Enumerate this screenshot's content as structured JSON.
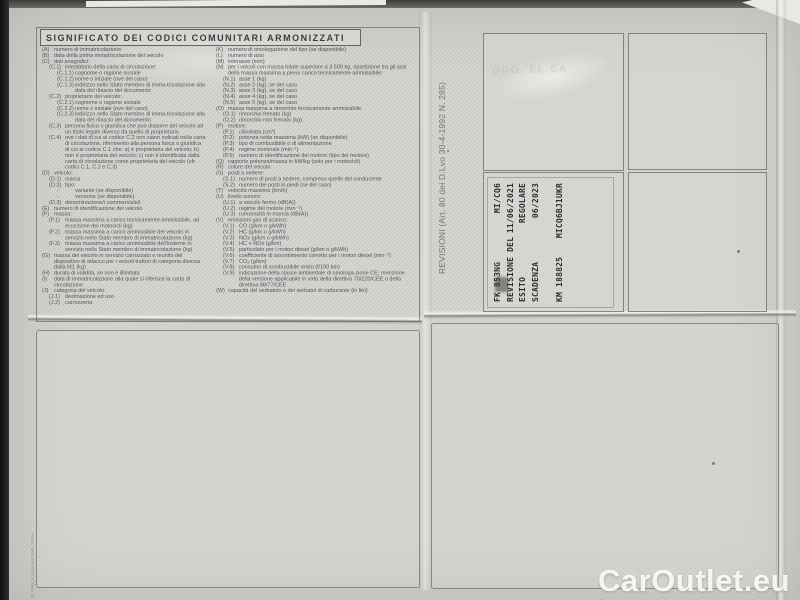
{
  "colors": {
    "paper": "#d6d5d1",
    "legend_ink": "#56565a",
    "stamp_ink": "#2d2d2f",
    "border": "#76766e",
    "watermark_text": "#fdfdfa"
  },
  "header": {
    "title": "SIGNIFICATO DEI CODICI COMUNITARI ARMONIZZATI"
  },
  "legend": {
    "left": [
      {
        "c": "(A)",
        "t": "numero di immatricolazione",
        "i": 0
      },
      {
        "c": "(B)",
        "t": "data della prima immatricolazione del veicolo",
        "i": 0
      },
      {
        "c": "(C)",
        "t": "dati anagrafici:",
        "i": 0
      },
      {
        "c": "(C.1)",
        "t": "intestatario della carta di circolazione:",
        "i": 1
      },
      {
        "c": "(C.1.1)",
        "t": "cognome o ragione sociale",
        "i": 2
      },
      {
        "c": "(C.1.2)",
        "t": "nome o iniziale (ove del caso)",
        "i": 2
      },
      {
        "c": "(C.1.3)",
        "t": "indirizzo nello Stato membro di imma-tricolazione alla data del rilascio del documento",
        "i": 2
      },
      {
        "c": "(C.2)",
        "t": "proprietario del veicolo:",
        "i": 1
      },
      {
        "c": "(C.2.1)",
        "t": "cognome o ragione sociale",
        "i": 2
      },
      {
        "c": "(C.2.2)",
        "t": "nome o iniziale (ove del caso)",
        "i": 2
      },
      {
        "c": "(C.2.3)",
        "t": "indirizzo nello Stato membro di imma-tricolazione alla data del rilascio del documento",
        "i": 2
      },
      {
        "c": "(C.3)",
        "t": "persona fisica o giuridica che può disporre del veicolo ad un titolo legale diverso da quello di proprietario",
        "i": 1
      },
      {
        "c": "(C.4)",
        "t": "ove i dati di cui al codice C.2 non siano indicati nella carta di circolazione, riferimento alla persona fisica o giuridica di cui al codice C.1 che: a) è proprietaria del veicolo; b) non è proprietaria del veicolo; c) non è identificata dalla carta di circolazione come proprietaria del veicolo (cfr. codici C.1, C.2 e C.3)",
        "i": 1
      },
      {
        "c": "(D)",
        "t": "veicolo:",
        "i": 0
      },
      {
        "c": "(D.1)",
        "t": "marca",
        "i": 1
      },
      {
        "c": "(D.2)",
        "t": "tipo:",
        "i": 1
      },
      {
        "c": "-",
        "t": "variante (se disponibile)",
        "i": 2
      },
      {
        "c": "-",
        "t": "versione (se disponibile)",
        "i": 2
      },
      {
        "c": "(D.3)",
        "t": "denominazione/i commerciale/i",
        "i": 1
      },
      {
        "c": "(E)",
        "t": "numero di identificazione del veicolo",
        "i": 0
      },
      {
        "c": "(F)",
        "t": "massa:",
        "i": 0
      },
      {
        "c": "(F.1)",
        "t": "massa massima a carico tecnicamente ammissibile, ad eccezione dei motocicli (kg)",
        "i": 1
      },
      {
        "c": "(F.2)",
        "t": "massa massima a carico ammissibile del veicolo in servizio nello Stato membro di immatricolazione (kg)",
        "i": 1
      },
      {
        "c": "(F.3)",
        "t": "massa massima a carico ammissibile dell'insieme in servizio nello Stato membro di immatricolazione (kg)",
        "i": 1
      },
      {
        "c": "(G)",
        "t": "massa del veicolo in servizio carrozzato e munito del dispositivo di attacco per i veicoli trattori di categoria diversa dalla M1 (kg)",
        "i": 0
      },
      {
        "c": "(H)",
        "t": "durata di validità, se non è illimitata",
        "i": 0
      },
      {
        "c": "(I)",
        "t": "data di immatricolazione alla quale si riferisce la carta di circolazione",
        "i": 0
      },
      {
        "c": "(J)",
        "t": "categoria del veicolo:",
        "i": 0
      },
      {
        "c": "(J.1)",
        "t": "destinazione ed uso",
        "i": 1
      },
      {
        "c": "(J.2)",
        "t": "carrozzeria",
        "i": 1
      }
    ],
    "right": [
      {
        "c": "(K)",
        "t": "numero di omologazione del tipo (se disponibile)",
        "i": 0
      },
      {
        "c": "(L)",
        "t": "numero di assi",
        "i": 0
      },
      {
        "c": "(M)",
        "t": "interasse (mm)",
        "i": 0
      },
      {
        "c": "(N)",
        "t": "per i veicoli con massa totale superiore a 3.500 kg, ripartizione tra gli assi della massa massima a pieno carico tecnicamente ammissibile:",
        "i": 0
      },
      {
        "c": "(N.1)",
        "t": "asse 1 (kg)",
        "i": 1
      },
      {
        "c": "(N.2)",
        "t": "asse 2 (kg), se del caso",
        "i": 1
      },
      {
        "c": "(N.3)",
        "t": "asse 3 (kg), se del caso",
        "i": 1
      },
      {
        "c": "(N.4)",
        "t": "asse 4 (kg), se del caso",
        "i": 1
      },
      {
        "c": "(N.5)",
        "t": "asse 5 (kg), se del caso",
        "i": 1
      },
      {
        "c": "(O)",
        "t": "massa massima a rimorchio tecnicamente ammissibile:",
        "i": 0
      },
      {
        "c": "(O.1)",
        "t": "rimorchio frenato (kg)",
        "i": 1
      },
      {
        "c": "(O.2)",
        "t": "rimorchio non frenato (kg)",
        "i": 1
      },
      {
        "c": "(P)",
        "t": "motore:",
        "i": 0
      },
      {
        "c": "(P.1)",
        "t": "cilindrata (cm³)",
        "i": 1
      },
      {
        "c": "(P.2)",
        "t": "potenza netta massima (kW) (se disponibile)",
        "i": 1
      },
      {
        "c": "(P.3)",
        "t": "tipo di combustibile o di alimentazione",
        "i": 1
      },
      {
        "c": "(P.4)",
        "t": "regime nominale (min⁻¹)",
        "i": 1
      },
      {
        "c": "(P.5)",
        "t": "numero di identificazione del motore (tipo del motore)",
        "i": 1
      },
      {
        "c": "(Q)",
        "t": "rapporto potenza/massa in kW/kg (solo per i motocicli)",
        "i": 0
      },
      {
        "c": "(R)",
        "t": "colore del veicolo",
        "i": 0
      },
      {
        "c": "(S)",
        "t": "posti a sedere:",
        "i": 0
      },
      {
        "c": "(S.1)",
        "t": "numero di posti a sedere, compreso quello del conducente",
        "i": 1
      },
      {
        "c": "(S.2)",
        "t": "numero dei posti in piedi (se del caso)",
        "i": 1
      },
      {
        "c": "(T)",
        "t": "velocità massima (km/h)",
        "i": 0
      },
      {
        "c": "(U)",
        "t": "livello sonoro:",
        "i": 0
      },
      {
        "c": "(U.1)",
        "t": "a veicolo fermo (dB(A))",
        "i": 1
      },
      {
        "c": "(U.2)",
        "t": "regime del motore (min⁻¹)",
        "i": 1
      },
      {
        "c": "(U.3)",
        "t": "rumorosità in marcia (dB(A))",
        "i": 1
      },
      {
        "c": "(V)",
        "t": "emissioni gas di scarico:",
        "i": 0
      },
      {
        "c": "(V.1)",
        "t": "CO (g/km o g/kWh)",
        "i": 1
      },
      {
        "c": "(V.2)",
        "t": "HC (g/km o g/kWh)",
        "i": 1
      },
      {
        "c": "(V.3)",
        "t": "NOx (g/km o g/kWh)",
        "i": 1
      },
      {
        "c": "(V.4)",
        "t": "HC + NOx (g/km)",
        "i": 1
      },
      {
        "c": "(V.5)",
        "t": "particolato per i motori diesel (g/km o g/kWh)",
        "i": 1
      },
      {
        "c": "(V.6)",
        "t": "coefficiente di assorbimento corretto per i motori diesel (min⁻¹)",
        "i": 1
      },
      {
        "c": "(V.7)",
        "t": "CO₂ (g/km)",
        "i": 1
      },
      {
        "c": "(V.8)",
        "t": "consumo di combustibile misto (l/100 km)",
        "i": 1
      },
      {
        "c": "(V.9)",
        "t": "indicazione della classe ambientale di omologa-zione CE; menzione della versione applicabile in virtù della direttiva 70/220/CEE o della direttiva 88/77/CEE",
        "i": 1
      },
      {
        "c": "(W)",
        "t": "capacità del serbatoio o dei serbatoi di carburante (in litri)",
        "i": 0
      }
    ]
  },
  "revisioni": {
    "side_label": "REVISIONI (Art. 80 del D.Lvo 30-4-1992 N. 285)",
    "ghost_text": "ODO  'EL  CA",
    "stamp_lines": [
      {
        "l": "FK 853NG",
        "r": "MI/CQ6"
      },
      {
        "l": "REVISIONE DEL",
        "r": "11/06/2021"
      },
      {
        "l": "ESITO",
        "r": "REGOLARE"
      },
      {
        "l": "SCADENZA",
        "r": "06/2023"
      },
      {
        "l": "KM 188825",
        "r": "MICQ6BJ1UKR",
        "gap": true
      }
    ]
  },
  "edge_print": "Ist. Poligr. e Zecca dello Stato - Roma",
  "watermark": "CarOutlet.eu"
}
